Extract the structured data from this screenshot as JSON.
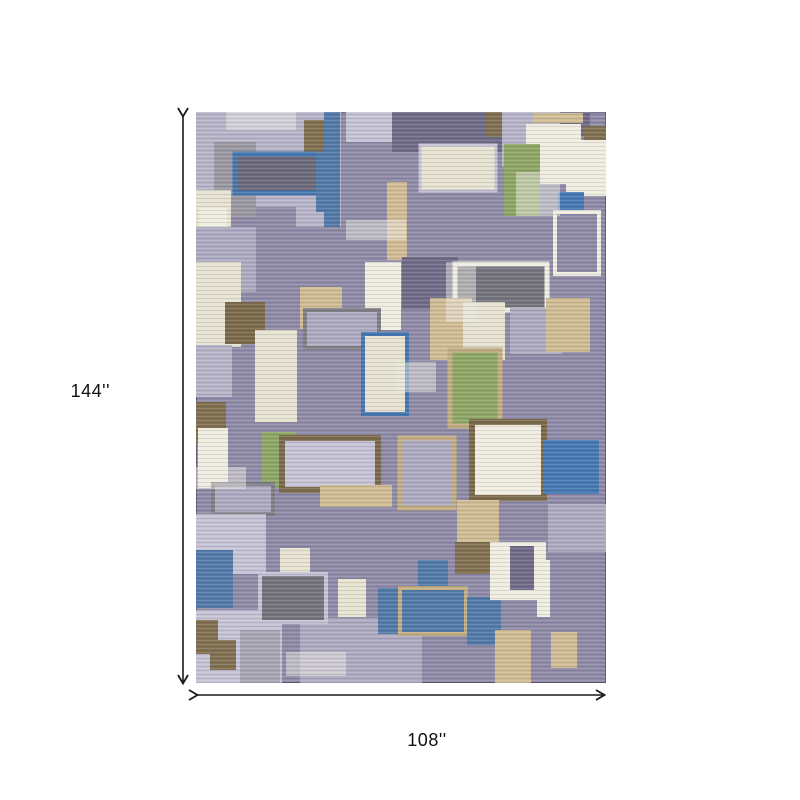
{
  "product": {
    "type_label": "area-rug-dimension-diagram"
  },
  "dimensions": {
    "height_label": "144''",
    "width_label": "108''",
    "arrow_color": "#1a1a1a"
  },
  "rug": {
    "x": 196,
    "y": 112,
    "width": 410,
    "height": 571,
    "edge_color": "#5f5a78",
    "palette": {
      "base": "#8f8ba7",
      "lavLight": "#b7b4c8",
      "lavMid": "#aeabc1",
      "lavPale": "#c6c3d4",
      "darkPurple": "#6f6b86",
      "slate": "#6b6979",
      "grayDark": "#73737c",
      "gray": "#9b99a1",
      "grayMid": "#a9a7b3",
      "grayStroke": "#7f7f85",
      "blue": "#527aa8",
      "blueBright": "#4478b0",
      "green": "#8ea765",
      "cream": "#e7e3d1",
      "white": "#f0ede1",
      "tan": "#d0bd94",
      "tanBorder": "#c2ae82",
      "brown": "#80704f",
      "brownDark": "#7b6a4a",
      "wear": "rgba(238,236,228,0.5)"
    },
    "patches": [
      {
        "x": 0,
        "y": 0,
        "w": 125,
        "h": 95,
        "f": "lavLight"
      },
      {
        "x": 100,
        "y": 0,
        "w": 45,
        "h": 115,
        "f": "lavLight"
      },
      {
        "x": 150,
        "y": 0,
        "w": 60,
        "h": 30,
        "f": "lavPale"
      },
      {
        "x": 196,
        "y": 0,
        "w": 110,
        "h": 40,
        "f": "darkPurple"
      },
      {
        "x": 290,
        "y": 0,
        "w": 40,
        "h": 25,
        "f": "brown"
      },
      {
        "x": 306,
        "y": 0,
        "w": 75,
        "h": 55,
        "f": "lavLight"
      },
      {
        "x": 364,
        "y": 0,
        "w": 30,
        "h": 24,
        "f": "darkPurple"
      },
      {
        "x": 337,
        "y": 1,
        "w": 50,
        "h": 10,
        "f": "tan"
      },
      {
        "x": 18,
        "y": 30,
        "w": 42,
        "h": 75,
        "f": "gray"
      },
      {
        "x": 108,
        "y": 8,
        "w": 26,
        "h": 50,
        "f": "brown"
      },
      {
        "x": 128,
        "y": 0,
        "w": 16,
        "h": 115,
        "f": "blue"
      },
      {
        "x": 330,
        "y": 12,
        "w": 55,
        "h": 60,
        "f": "white"
      },
      {
        "x": 388,
        "y": 14,
        "w": 22,
        "h": 40,
        "f": "brown"
      },
      {
        "x": 370,
        "y": 28,
        "w": 40,
        "h": 56,
        "f": "white"
      },
      {
        "x": 0,
        "y": 78,
        "w": 35,
        "h": 42,
        "f": "cream"
      },
      {
        "x": 224,
        "y": 33,
        "w": 76,
        "h": 46,
        "f": "cream",
        "s": "lavPale",
        "sw": 3
      },
      {
        "x": 308,
        "y": 32,
        "w": 36,
        "h": 72,
        "f": "green"
      },
      {
        "x": 344,
        "y": 22,
        "w": 40,
        "h": 45,
        "f": "white"
      },
      {
        "x": 39,
        "y": 42,
        "w": 86,
        "h": 39,
        "f": "slate",
        "s": "blueBright",
        "sw": 5
      },
      {
        "x": 120,
        "y": 40,
        "w": 22,
        "h": 60,
        "f": "blue"
      },
      {
        "x": 191,
        "y": 70,
        "w": 20,
        "h": 78,
        "f": "tan"
      },
      {
        "x": 362,
        "y": 80,
        "w": 26,
        "h": 22,
        "f": "blueBright"
      },
      {
        "x": 359,
        "y": 100,
        "w": 44,
        "h": 62,
        "f": "base",
        "s": "white",
        "sw": 4
      },
      {
        "x": 3,
        "y": 96,
        "w": 28,
        "h": 52,
        "f": "white"
      },
      {
        "x": 25,
        "y": 125,
        "w": 20,
        "h": 28,
        "f": "brown"
      },
      {
        "x": 0,
        "y": 115,
        "w": 60,
        "h": 65,
        "f": "lavMid"
      },
      {
        "x": 0,
        "y": 150,
        "w": 45,
        "h": 85,
        "f": "cream"
      },
      {
        "x": 29,
        "y": 190,
        "w": 40,
        "h": 42,
        "f": "brownDark"
      },
      {
        "x": 104,
        "y": 175,
        "w": 42,
        "h": 42,
        "f": "tan"
      },
      {
        "x": 169,
        "y": 150,
        "w": 36,
        "h": 68,
        "f": "white"
      },
      {
        "x": 206,
        "y": 145,
        "w": 56,
        "h": 52,
        "f": "darkPurple"
      },
      {
        "x": 259,
        "y": 152,
        "w": 92,
        "h": 46,
        "f": "grayDark",
        "s": "white",
        "sw": 5
      },
      {
        "x": 234,
        "y": 186,
        "w": 42,
        "h": 62,
        "f": "tan"
      },
      {
        "x": 267,
        "y": 190,
        "w": 42,
        "h": 58,
        "f": "cream"
      },
      {
        "x": 314,
        "y": 196,
        "w": 52,
        "h": 46,
        "f": "lavMid"
      },
      {
        "x": 350,
        "y": 186,
        "w": 44,
        "h": 54,
        "f": "tan"
      },
      {
        "x": 109,
        "y": 198,
        "w": 74,
        "h": 38,
        "f": "lavMid",
        "s": "grayStroke",
        "sw": 4
      },
      {
        "x": 59,
        "y": 218,
        "w": 42,
        "h": 92,
        "f": "cream"
      },
      {
        "x": 0,
        "y": 233,
        "w": 36,
        "h": 52,
        "f": "lavLight"
      },
      {
        "x": 167,
        "y": 222,
        "w": 44,
        "h": 80,
        "f": "cream",
        "s": "blueBright",
        "sw": 4
      },
      {
        "x": 254,
        "y": 238,
        "w": 50,
        "h": 76,
        "f": "green",
        "s": "tanBorder",
        "sw": 5
      },
      {
        "x": 0,
        "y": 290,
        "w": 30,
        "h": 40,
        "f": "brown"
      },
      {
        "x": 2,
        "y": 316,
        "w": 30,
        "h": 60,
        "f": "white"
      },
      {
        "x": 66,
        "y": 320,
        "w": 34,
        "h": 56,
        "f": "green"
      },
      {
        "x": 86,
        "y": 326,
        "w": 96,
        "h": 52,
        "f": "lavPale",
        "s": "brownDark",
        "sw": 6
      },
      {
        "x": 124,
        "y": 373,
        "w": 72,
        "h": 22,
        "f": "tan"
      },
      {
        "x": 17,
        "y": 372,
        "w": 60,
        "h": 30,
        "f": "lavMid",
        "s": "grayStroke",
        "sw": 4
      },
      {
        "x": 204,
        "y": 326,
        "w": 54,
        "h": 70,
        "f": "lavMid",
        "s": "tanBorder",
        "sw": 5
      },
      {
        "x": 276,
        "y": 310,
        "w": 72,
        "h": 76,
        "f": "white",
        "s": "brownDark",
        "sw": 6
      },
      {
        "x": 347,
        "y": 328,
        "w": 56,
        "h": 54,
        "f": "blueBright"
      },
      {
        "x": 352,
        "y": 392,
        "w": 58,
        "h": 48,
        "f": "lavMid"
      },
      {
        "x": 261,
        "y": 388,
        "w": 42,
        "h": 42,
        "f": "tan"
      },
      {
        "x": 0,
        "y": 402,
        "w": 70,
        "h": 60,
        "f": "lavPale"
      },
      {
        "x": 0,
        "y": 498,
        "w": 86,
        "h": 73,
        "f": "lavPale"
      },
      {
        "x": 104,
        "y": 506,
        "w": 122,
        "h": 65,
        "f": "lavMid"
      },
      {
        "x": 0,
        "y": 438,
        "w": 37,
        "h": 58,
        "f": "blue"
      },
      {
        "x": 84,
        "y": 436,
        "w": 30,
        "h": 24,
        "f": "cream"
      },
      {
        "x": 64,
        "y": 462,
        "w": 66,
        "h": 48,
        "f": "grayDark",
        "s": "lavPale",
        "sw": 4
      },
      {
        "x": 142,
        "y": 467,
        "w": 28,
        "h": 38,
        "f": "cream"
      },
      {
        "x": 182,
        "y": 476,
        "w": 26,
        "h": 46,
        "f": "blue"
      },
      {
        "x": 222,
        "y": 448,
        "w": 30,
        "h": 28,
        "f": "blue"
      },
      {
        "x": 204,
        "y": 476,
        "w": 66,
        "h": 46,
        "f": "blue",
        "s": "tanBorder",
        "sw": 4
      },
      {
        "x": 271,
        "y": 485,
        "w": 34,
        "h": 48,
        "f": "blue"
      },
      {
        "x": 259,
        "y": 430,
        "w": 40,
        "h": 32,
        "f": "brown"
      },
      {
        "x": 294,
        "y": 430,
        "w": 56,
        "h": 58,
        "f": "white"
      },
      {
        "x": 314,
        "y": 434,
        "w": 24,
        "h": 44,
        "f": "darkPurple"
      },
      {
        "x": 341,
        "y": 448,
        "w": 13,
        "h": 57,
        "f": "white"
      },
      {
        "x": 299,
        "y": 518,
        "w": 36,
        "h": 53,
        "f": "tan"
      },
      {
        "x": 355,
        "y": 520,
        "w": 26,
        "h": 36,
        "f": "tan"
      },
      {
        "x": 0,
        "y": 508,
        "w": 22,
        "h": 34,
        "f": "brown"
      },
      {
        "x": 14,
        "y": 528,
        "w": 26,
        "h": 30,
        "f": "brown"
      },
      {
        "x": 44,
        "y": 518,
        "w": 40,
        "h": 53,
        "f": "grayMid"
      },
      {
        "x": 30,
        "y": 0,
        "w": 70,
        "h": 18,
        "f": "wear"
      },
      {
        "x": 150,
        "y": 108,
        "w": 60,
        "h": 20,
        "f": "wear"
      },
      {
        "x": 0,
        "y": 355,
        "w": 50,
        "h": 22,
        "f": "wear"
      },
      {
        "x": 200,
        "y": 250,
        "w": 40,
        "h": 30,
        "f": "wear"
      },
      {
        "x": 320,
        "y": 60,
        "w": 44,
        "h": 44,
        "f": "wear"
      },
      {
        "x": 90,
        "y": 540,
        "w": 60,
        "h": 24,
        "f": "wear"
      },
      {
        "x": 250,
        "y": 150,
        "w": 30,
        "h": 60,
        "f": "wear"
      }
    ]
  }
}
